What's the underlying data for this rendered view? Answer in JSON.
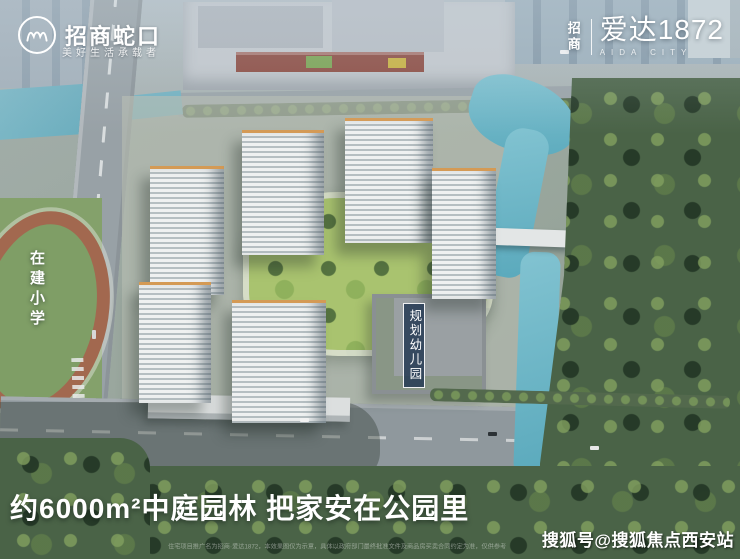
{
  "header": {
    "developer": {
      "brand": "招商蛇口",
      "tagline": "美好生活承载者"
    },
    "project": {
      "prefix": "招商",
      "name": "爱达1872",
      "latin": "AIDA CITY"
    }
  },
  "map_labels": {
    "school": "在建小学",
    "kindergarten": "规划幼儿园"
  },
  "caption": {
    "headline": "约6000m²中庭园林 把家安在公园里"
  },
  "footer": {
    "disclaimer": "住宅项目推广名为招商·爱达1872，本效果图仅为示意，具体以政府部门最终批准文件及商品房买卖合同约定为准，仅供参考",
    "watermark": "搜狐号@搜狐焦点西安站"
  },
  "palette": {
    "water": "#6fb5c5",
    "forest": "#4a6347",
    "lawn": "#a9c36f",
    "track": "#a2684f",
    "tower_facade": "#e7eaea",
    "tower_roof_accent": "#d49a55",
    "badge_bg": "#243a54",
    "overlay_text": "#ffffff",
    "mall_accent_red": "#8c4a40"
  }
}
